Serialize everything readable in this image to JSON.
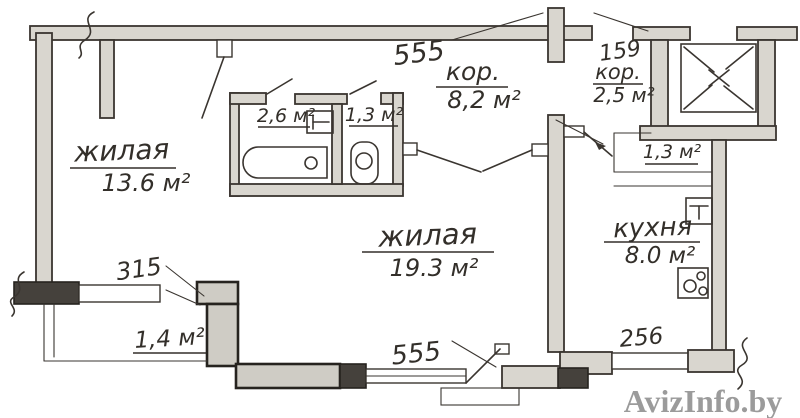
{
  "plan": {
    "room_living_left": {
      "name": "жилая",
      "area": "13.6 м²"
    },
    "room_living_center": {
      "name": "жилая",
      "area": "19.3 м²"
    },
    "kitchen": {
      "name": "кухня",
      "area": "8.0 м²"
    },
    "hall_main": {
      "dim": "555",
      "name": "кор.",
      "area": "8,2 м²"
    },
    "hall_entry": {
      "dim": "159",
      "name": "кор.",
      "area": "2,5 м²"
    },
    "bathroom": {
      "area": "2,6 м²"
    },
    "wc": {
      "area": "1,3 м²"
    },
    "closet": {
      "area": "1,3 м²"
    },
    "balcony": {
      "dim": "315",
      "area": "1,4 м²"
    },
    "window_south": {
      "dim": "555"
    },
    "window_east": {
      "dim": "256"
    }
  },
  "watermark": {
    "text": "AvizInfo.by"
  },
  "colors": {
    "ink": "#3a3530",
    "wall_fill": "#d9d6cf",
    "wall_dark": "#45413c",
    "paper": "#ffffff",
    "watermark_gray": "#9b9b9b"
  }
}
